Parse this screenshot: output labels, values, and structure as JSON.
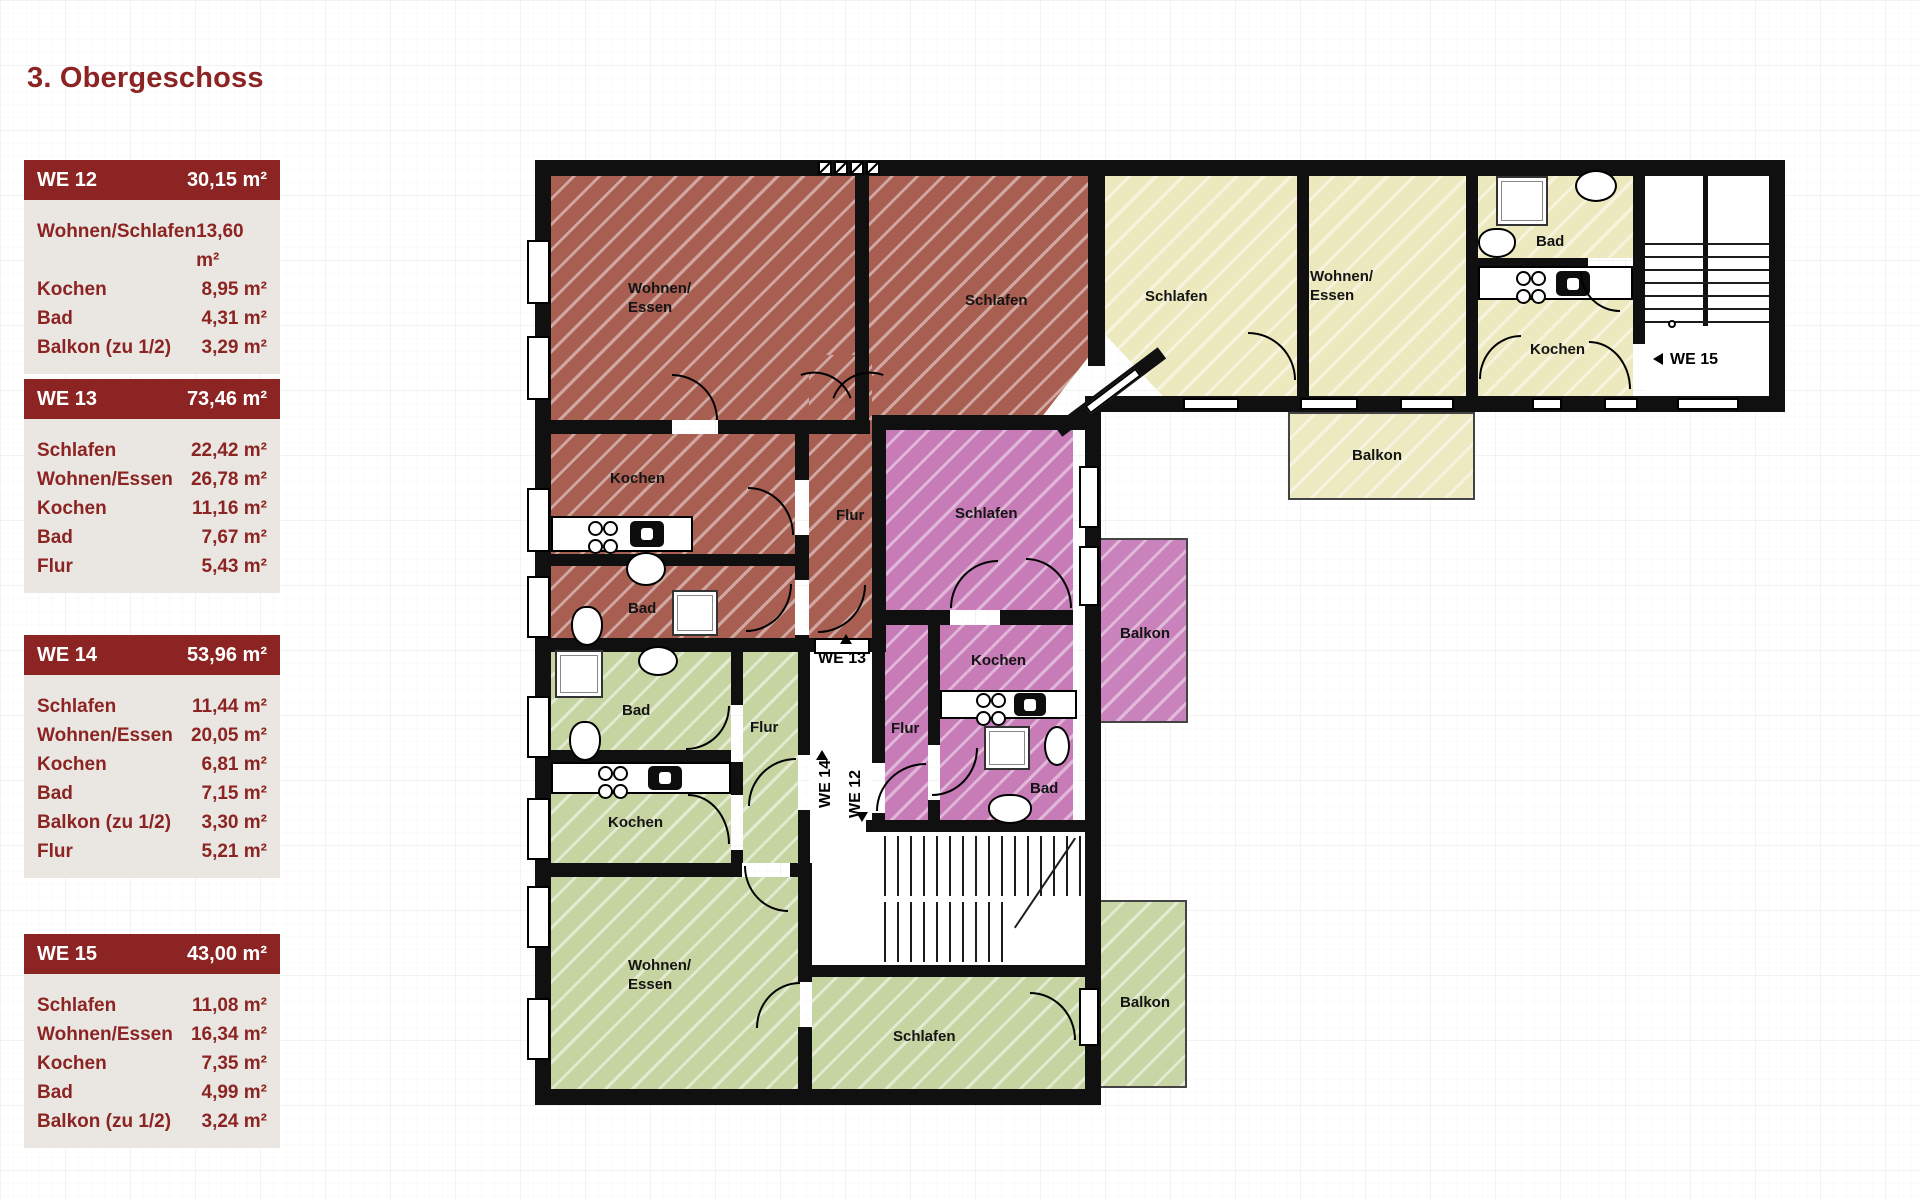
{
  "title": "3. Obergeschoss",
  "legend_tables": [
    {
      "unit": "WE 12",
      "area": "30,15 m²",
      "rows": [
        {
          "label": "Wohnen/Schlafen",
          "value": "13,60 m²"
        },
        {
          "label": "Kochen",
          "value": "8,95 m²"
        },
        {
          "label": "Bad",
          "value": "4,31 m²"
        },
        {
          "label": "Balkon (zu 1/2)",
          "value": "3,29 m²"
        }
      ]
    },
    {
      "unit": "WE 13",
      "area": "73,46 m²",
      "rows": [
        {
          "label": "Schlafen",
          "value": "22,42 m²"
        },
        {
          "label": "Wohnen/Essen",
          "value": "26,78 m²"
        },
        {
          "label": "Kochen",
          "value": "11,16 m²"
        },
        {
          "label": "Bad",
          "value": "7,67 m²"
        },
        {
          "label": "Flur",
          "value": "5,43 m²"
        }
      ]
    },
    {
      "unit": "WE 14",
      "area": "53,96 m²",
      "rows": [
        {
          "label": "Schlafen",
          "value": "11,44 m²"
        },
        {
          "label": "Wohnen/Essen",
          "value": "20,05 m²"
        },
        {
          "label": "Kochen",
          "value": "6,81 m²"
        },
        {
          "label": "Bad",
          "value": "7,15 m²"
        },
        {
          "label": "Balkon (zu 1/2)",
          "value": "3,30 m²"
        },
        {
          "label": "Flur",
          "value": "5,21 m²"
        }
      ]
    },
    {
      "unit": "WE 15",
      "area": "43,00 m²",
      "rows": [
        {
          "label": "Schlafen",
          "value": "11,08 m²"
        },
        {
          "label": "Wohnen/Essen",
          "value": "16,34 m²"
        },
        {
          "label": "Kochen",
          "value": "7,35 m²"
        },
        {
          "label": "Bad",
          "value": "4,99 m²"
        },
        {
          "label": "Balkon (zu 1/2)",
          "value": "3,24 m²"
        }
      ]
    }
  ],
  "plan": {
    "colors": {
      "we13": "#A85F52",
      "we12": "#C77CB8",
      "we15": "#EDE9BE",
      "we14": "#C5D4A0",
      "wall": "#101010",
      "accent": "#8B2422"
    },
    "labels": {
      "m_wohnen": "Wohnen/\nEssen",
      "m_schlafen": "Schlafen",
      "m_kochen": "Kochen",
      "m_bad": "Bad",
      "m_flur": "Flur",
      "y_schlafen": "Schlafen",
      "y_wohnen": "Wohnen/\nEssen",
      "y_bad": "Bad",
      "y_kochen": "Kochen",
      "y_balkon": "Balkon",
      "p_schlafen": "Schlafen",
      "p_kochen": "Kochen",
      "p_flur": "Flur",
      "p_bad": "Bad",
      "p_balkon": "Balkon",
      "g_bad": "Bad",
      "g_flur": "Flur",
      "g_kochen": "Kochen",
      "g_wohnen": "Wohnen/\nEssen",
      "g_schlafen": "Schlafen",
      "g_balkon": "Balkon",
      "door_we13": "WE 13",
      "door_we14": "WE 14",
      "door_we12": "WE 12",
      "door_we15": "WE 15"
    }
  }
}
